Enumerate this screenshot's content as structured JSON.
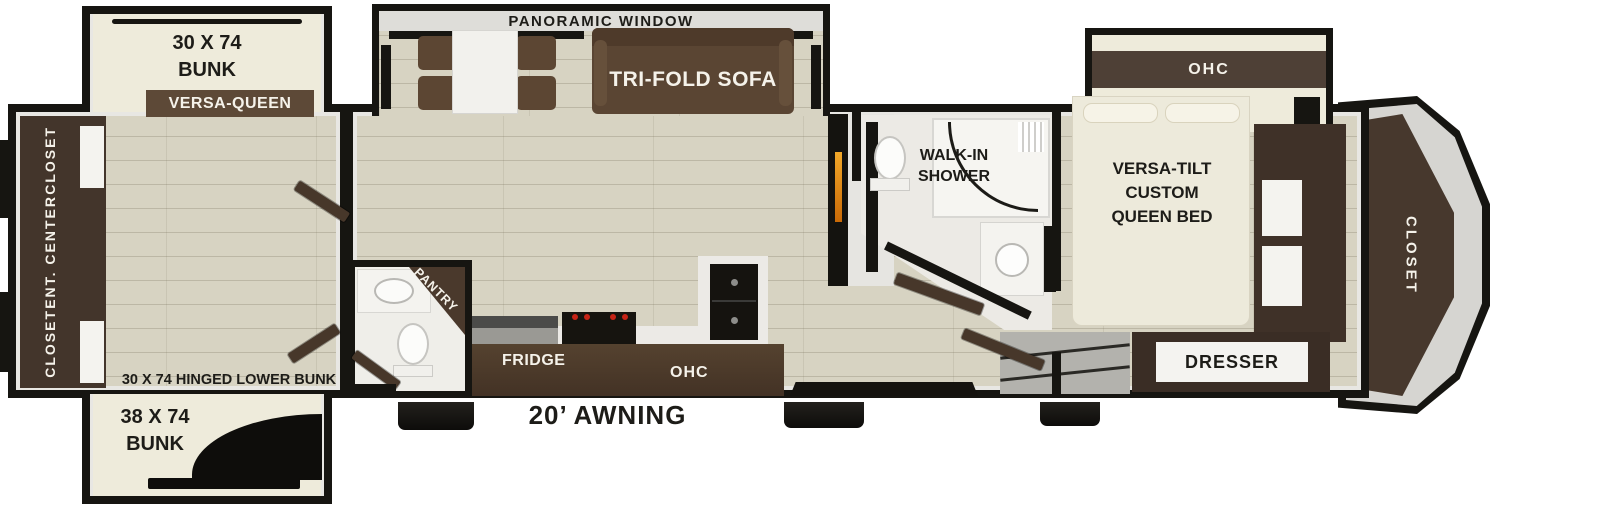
{
  "colors": {
    "wall": "#161511",
    "floor": "#d7d3c2",
    "mattress": "#eeebdb",
    "dark_wood": "#43352b",
    "mid_wood": "#5a4533",
    "label_bar_brown": "#5d4937",
    "flame_orange": "#e5880c",
    "burner_red": "#c62417",
    "text_dark": "#1d1c18",
    "text_light": "#f5f2ea"
  },
  "bunk_room": {
    "top_bunk_line1": "30 X 74",
    "top_bunk_line2": "BUNK",
    "versa_queen": "VERSA-QUEEN",
    "rear_wall_closet_top": "CLOSET",
    "rear_wall_ent_center": "ENT. CENTER",
    "rear_wall_closet_bottom": "CLOSET",
    "hinged_lower_bunk": "30 X 74 HINGED LOWER BUNK",
    "lower_bunk_line1": "38 X 74",
    "lower_bunk_line2": "BUNK"
  },
  "living_area": {
    "panoramic_window": "PANORAMIC WINDOW",
    "tri_fold_sofa": "TRI-FOLD SOFA"
  },
  "kitchen": {
    "pantry": "PANTRY",
    "fridge": "FRIDGE",
    "ohc": "OHC"
  },
  "bathroom": {
    "walk_in_line1": "WALK-IN",
    "walk_in_line2": "SHOWER"
  },
  "bedroom": {
    "ohc": "OHC",
    "bed_line1": "VERSA-TILT",
    "bed_line2": "CUSTOM",
    "bed_line3": "QUEEN BED",
    "dresser": "DRESSER",
    "front_closet": "CLOSET"
  },
  "exterior": {
    "awning": "20’ AWNING"
  }
}
